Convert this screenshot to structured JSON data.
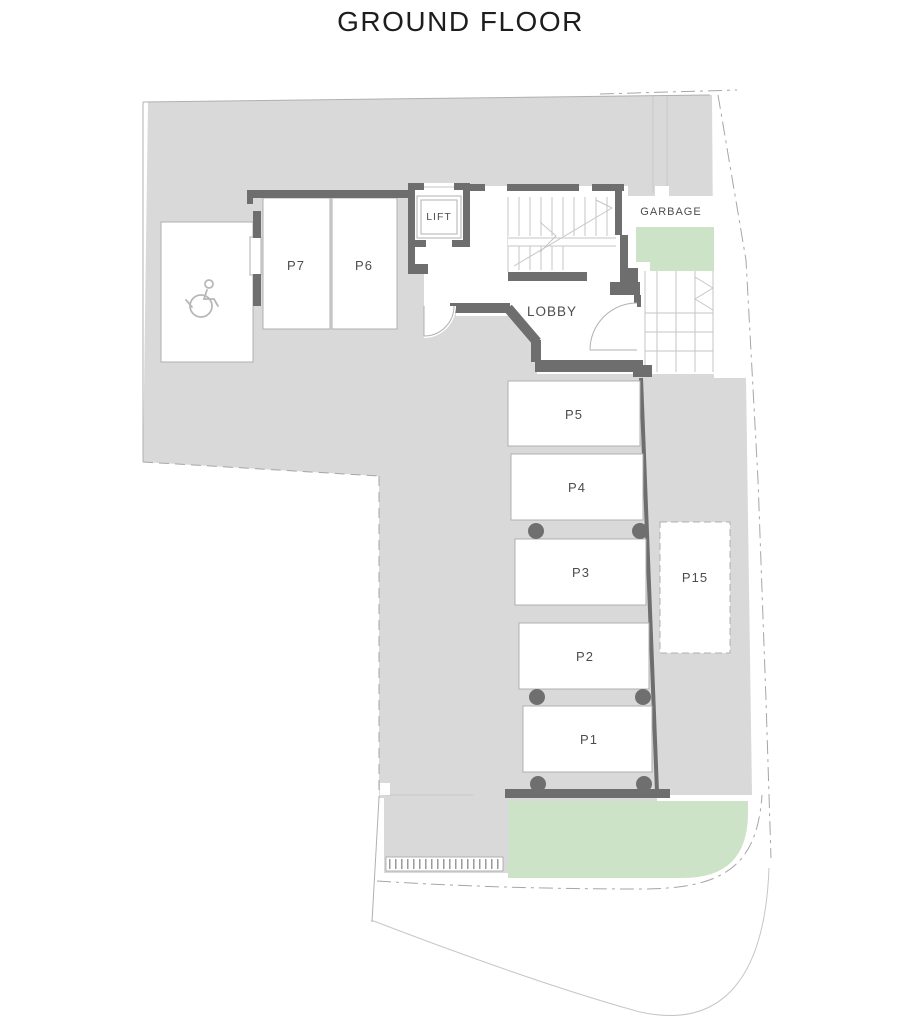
{
  "title": "GROUND FLOOR",
  "plan": {
    "rooms": {
      "lift": "LIFT",
      "lobby": "LOBBY",
      "garbage": "GARBAGE"
    },
    "parking": [
      {
        "label": "P7"
      },
      {
        "label": "P6"
      },
      {
        "label": "P5"
      },
      {
        "label": "P4"
      },
      {
        "label": "P3"
      },
      {
        "label": "P2"
      },
      {
        "label": "P1"
      },
      {
        "label": "P15"
      }
    ],
    "icons": [
      {
        "name": "wheelchair-icon",
        "meaning": "accessible parking space"
      }
    ],
    "colors": {
      "site": "#d9d9d9",
      "landscape": "#cde3c7",
      "wall": "#6e6e6e",
      "line": "#b0b0b0",
      "text": "#4d4d4d"
    }
  }
}
